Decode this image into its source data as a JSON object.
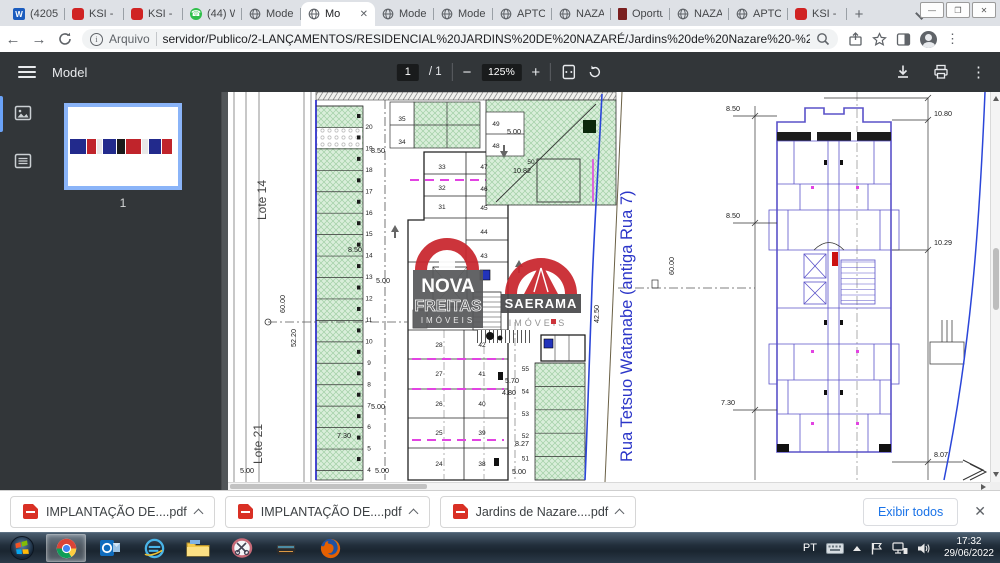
{
  "browser": {
    "tabs": [
      {
        "label": "(4205) L",
        "icon": "word"
      },
      {
        "label": "KSI - K",
        "icon": "ksi"
      },
      {
        "label": "KSI - K",
        "icon": "ksi"
      },
      {
        "label": "(44) Wh",
        "icon": "whatsapp"
      },
      {
        "label": "Model",
        "icon": "globe"
      },
      {
        "label": "Mo",
        "icon": "globe",
        "active": true
      },
      {
        "label": "Model",
        "icon": "globe"
      },
      {
        "label": "Model",
        "icon": "globe"
      },
      {
        "label": "APTOS",
        "icon": "globe"
      },
      {
        "label": "NAZAR",
        "icon": "globe"
      },
      {
        "label": "Oportu",
        "icon": "doc"
      },
      {
        "label": "NAZAR",
        "icon": "globe"
      },
      {
        "label": "APTOS",
        "icon": "globe"
      },
      {
        "label": "KSI - K",
        "icon": "ksi"
      }
    ],
    "new_tab_label": "+",
    "window_controls": {
      "minimize": "—",
      "maximize": "❐",
      "close": "✕"
    },
    "address": {
      "scheme_label": "Arquivo",
      "url": "servidor/Publico/2-LANÇAMENTOS/RESIDENCIAL%20JARDINS%20DE%20NAZARÉ/Jardins%20de%20Nazare%20-%20Prefeitura%20-%2008-06-2022-C..."
    }
  },
  "pdf": {
    "title": "Model",
    "page_current": "1",
    "page_total": "/ 1",
    "zoom": "125%",
    "thumb_label": "1"
  },
  "drawing": {
    "lote_top": "Lote 14",
    "lote_bottom": "Lote 21",
    "street": "Rua Tetsuo Watanabe (antiga Rua 7)",
    "left_stalls": [
      "20",
      "19",
      "18",
      "17",
      "16",
      "15",
      "14",
      "13",
      "12",
      "11",
      "10",
      "9",
      "8",
      "7",
      "6",
      "5",
      "4"
    ],
    "mid_left_stalls": [
      "28",
      "27",
      "26",
      "25",
      "24"
    ],
    "mid_right_stalls": [
      "42",
      "41",
      "40",
      "39",
      "38"
    ],
    "upper_stalls_a": [
      "35",
      "34"
    ],
    "upper_stalls_b": [
      "33",
      "32",
      "31"
    ],
    "upper_stalls_c": [
      "47",
      "46",
      "45",
      "44",
      "43"
    ],
    "top_stalls": [
      "49",
      "48"
    ],
    "stall_50": "50",
    "right_stalls": [
      "55",
      "54",
      "53",
      "52",
      "51"
    ],
    "dim_texts": [
      "8.50",
      "8.50",
      "5.00",
      "5.00",
      "7.30",
      "5.00",
      "5.00",
      "52.20",
      "60.00",
      "5.00",
      "10.82",
      "5.70",
      "4.80",
      "8.27",
      "5.00",
      "42.50",
      "60.00",
      "8.50",
      "8.50",
      "7.30",
      "10.80",
      "10.29",
      "8.07"
    ],
    "watermark_a": {
      "line1": "NOVA",
      "line2": "FREITAS",
      "line3": "IMÓVEIS"
    },
    "watermark_b": {
      "line1": "SAERAMA",
      "line2": "IMÓVEIS"
    },
    "colors": {
      "street_blue": "#2b35c8",
      "plan_purple": "#5a52c9",
      "magenta": "#e243e2",
      "green_fill": "#d9eeda",
      "red_logo": "#c9252d"
    }
  },
  "downloads": {
    "files": [
      "IMPLANTAÇÃO DE....pdf",
      "IMPLANTAÇÃO DE....pdf",
      "Jardins de Nazare....pdf"
    ],
    "show_all": "Exibir todos"
  },
  "taskbar": {
    "apps": [
      "start",
      "chrome",
      "outlook",
      "ie",
      "explorer",
      "snipping",
      "scanner",
      "firefox"
    ],
    "active_app": "chrome",
    "tray_lang": "PT",
    "time": "17:32",
    "date": "29/06/2022"
  }
}
